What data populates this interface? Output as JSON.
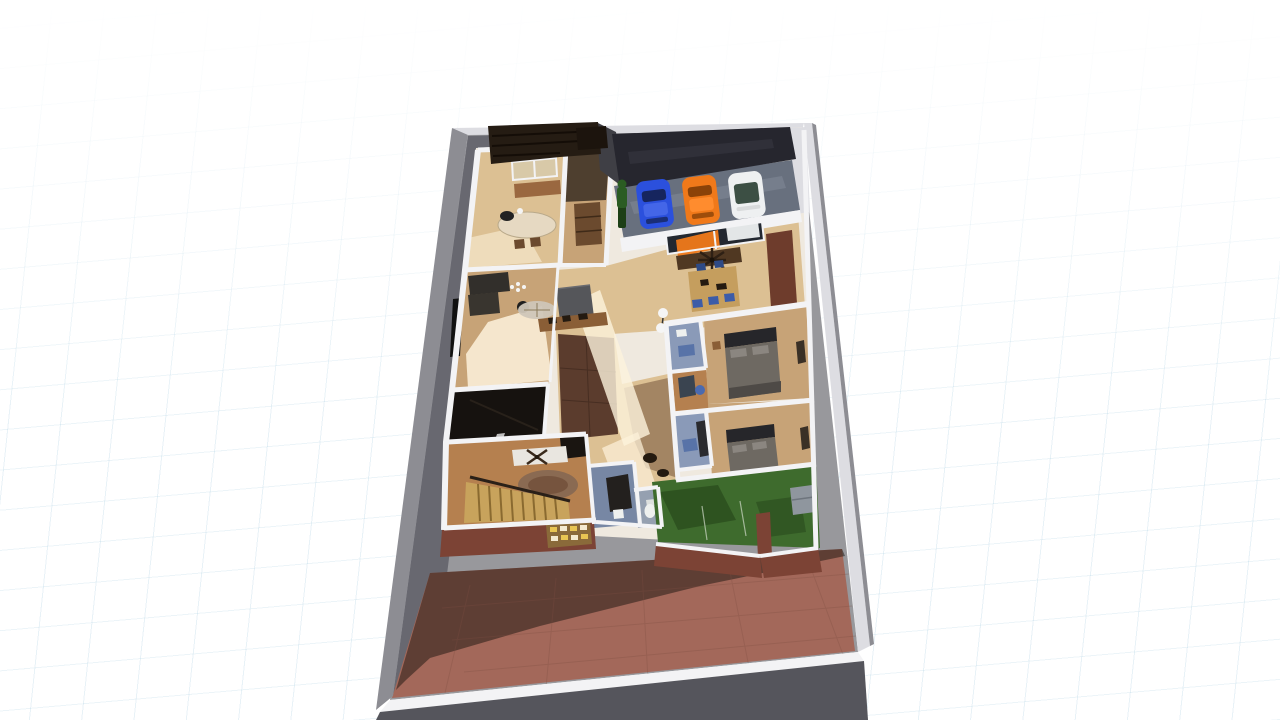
{
  "scene": {
    "type": "aerial-3d-floorplan-render",
    "view": "perspective-top-down",
    "rooms": [
      "kitchen",
      "entry",
      "garage",
      "dining-area",
      "living-room",
      "media-room",
      "family-room",
      "hallway",
      "small-bathroom",
      "toilet-nook",
      "bedroom-1",
      "bedroom-1-bath",
      "bedroom-2",
      "bedroom-2-bath",
      "lawn-courtyard",
      "paved-front-yard"
    ],
    "vehicles": [
      {
        "name": "blue-car",
        "color": "#2b50dd"
      },
      {
        "name": "orange-car",
        "color": "#f0791a"
      },
      {
        "name": "white-car",
        "color": "#eef0f1"
      }
    ],
    "figures": [
      {
        "name": "standing-person",
        "color": "#2b5c23"
      }
    ],
    "features": [
      "staircase",
      "garage-roof",
      "pergola",
      "perimeter-wall",
      "decorative-tile-panel"
    ]
  },
  "palette": {
    "concrete": "#98989c",
    "concrete_shadow": "#63636b",
    "wall_white": "#f3f3f5",
    "wall_light": "#dddde2",
    "lot_wall_grey": "#8d8d93",
    "lot_wall_front": "#55555c",
    "slab": "#efe9df",
    "paving": "#a3685a",
    "paving_shadow": "#271b16",
    "paving_line": "#7e4e42",
    "roof_dark": "#26262e",
    "roof_sheen": "#34343e",
    "roof_gap": "#3f3f45",
    "pergola": "#251c13",
    "pergola_slat": "#100a05",
    "chimney": "#1c140d",
    "garage_floor": "#68707e",
    "garage_light": "#7e8694",
    "car_blue": "#2b50dd",
    "car_blue_glass": "#16255e",
    "car_blue_roof": "#4466e8",
    "car_orange": "#f0791a",
    "car_orange_glass": "#8a4208",
    "car_orange_roof": "#ff8c2e",
    "car_white": "#eef0f1",
    "car_white_glass": "#3c4f44",
    "car_white_hood": "#d8dadb",
    "person": "#2b5c23",
    "person_dark": "#1d3f16",
    "wood_light": "#dcc093",
    "wood_mid": "#c7a377",
    "wood_warm": "#b5804f",
    "wood_dark": "#8a5e36",
    "brick": "#7c4335",
    "brick_shadow": "#533527",
    "brick_pillar": "#6e3c2c",
    "bath_blue": "#8a9ab8",
    "bath_blue2": "#7787a4",
    "nook_floor": "#95a0b0",
    "lawn": "#3e6b2d",
    "lawn_dark": "#2c4f1f",
    "bed_dark": "#26262a",
    "bed_grey": "#6e6962",
    "pillow": "#8b8680",
    "bed_foot": "#4e4a46",
    "sofa_dark": "#322f2b",
    "sofa_white": "#e9e6e0",
    "door_dark": "#1a1511",
    "rug_grey": "#cfc6b8",
    "rug_brown": "#8a6a52",
    "rug_brown_inner": "#76543e",
    "sun": "#fdf2dc",
    "table_wood": "#9a6840",
    "table_light": "#e6d9c2",
    "table_top": "#c59e5e",
    "shelf_brown": "#6b4a2e",
    "sideboard": "#503822",
    "chair_blue": "#3c5ca8",
    "chair_blue_dark": "#2e4a86",
    "chair_round_blue": "#4a6ab0",
    "mat_blue": "#5873a8",
    "stairs": "#c8a35c",
    "stairs_line": "#8a6a30",
    "rail_dark": "#2a2018",
    "box_grey": "#55565a",
    "item_dark": "#241a10",
    "panel_base": "#8a6a3a",
    "panel_yellow": "#e8c553",
    "panel_cream": "#f4ead0",
    "glass_tan": "#d8c9a8",
    "white": "#f2f2f2",
    "black": "#111111",
    "toilet_white": "#eef0ee",
    "media_floor": "#16120f",
    "media_streak": "#352c22",
    "glint": "#e8e8e8",
    "window_opening": "#232830",
    "fan_dark": "#2e2014",
    "desk_navy": "#3a4450",
    "closet_dark": "#3a3026",
    "panel_dark": "#2a2a2e",
    "bath_panel": "#23201e",
    "outdoor_sofa": "#8f969e",
    "shadow_brown": "#6a4a34",
    "entry_shadow": "#2f261d",
    "lamp_white": "#f5f5f5"
  }
}
